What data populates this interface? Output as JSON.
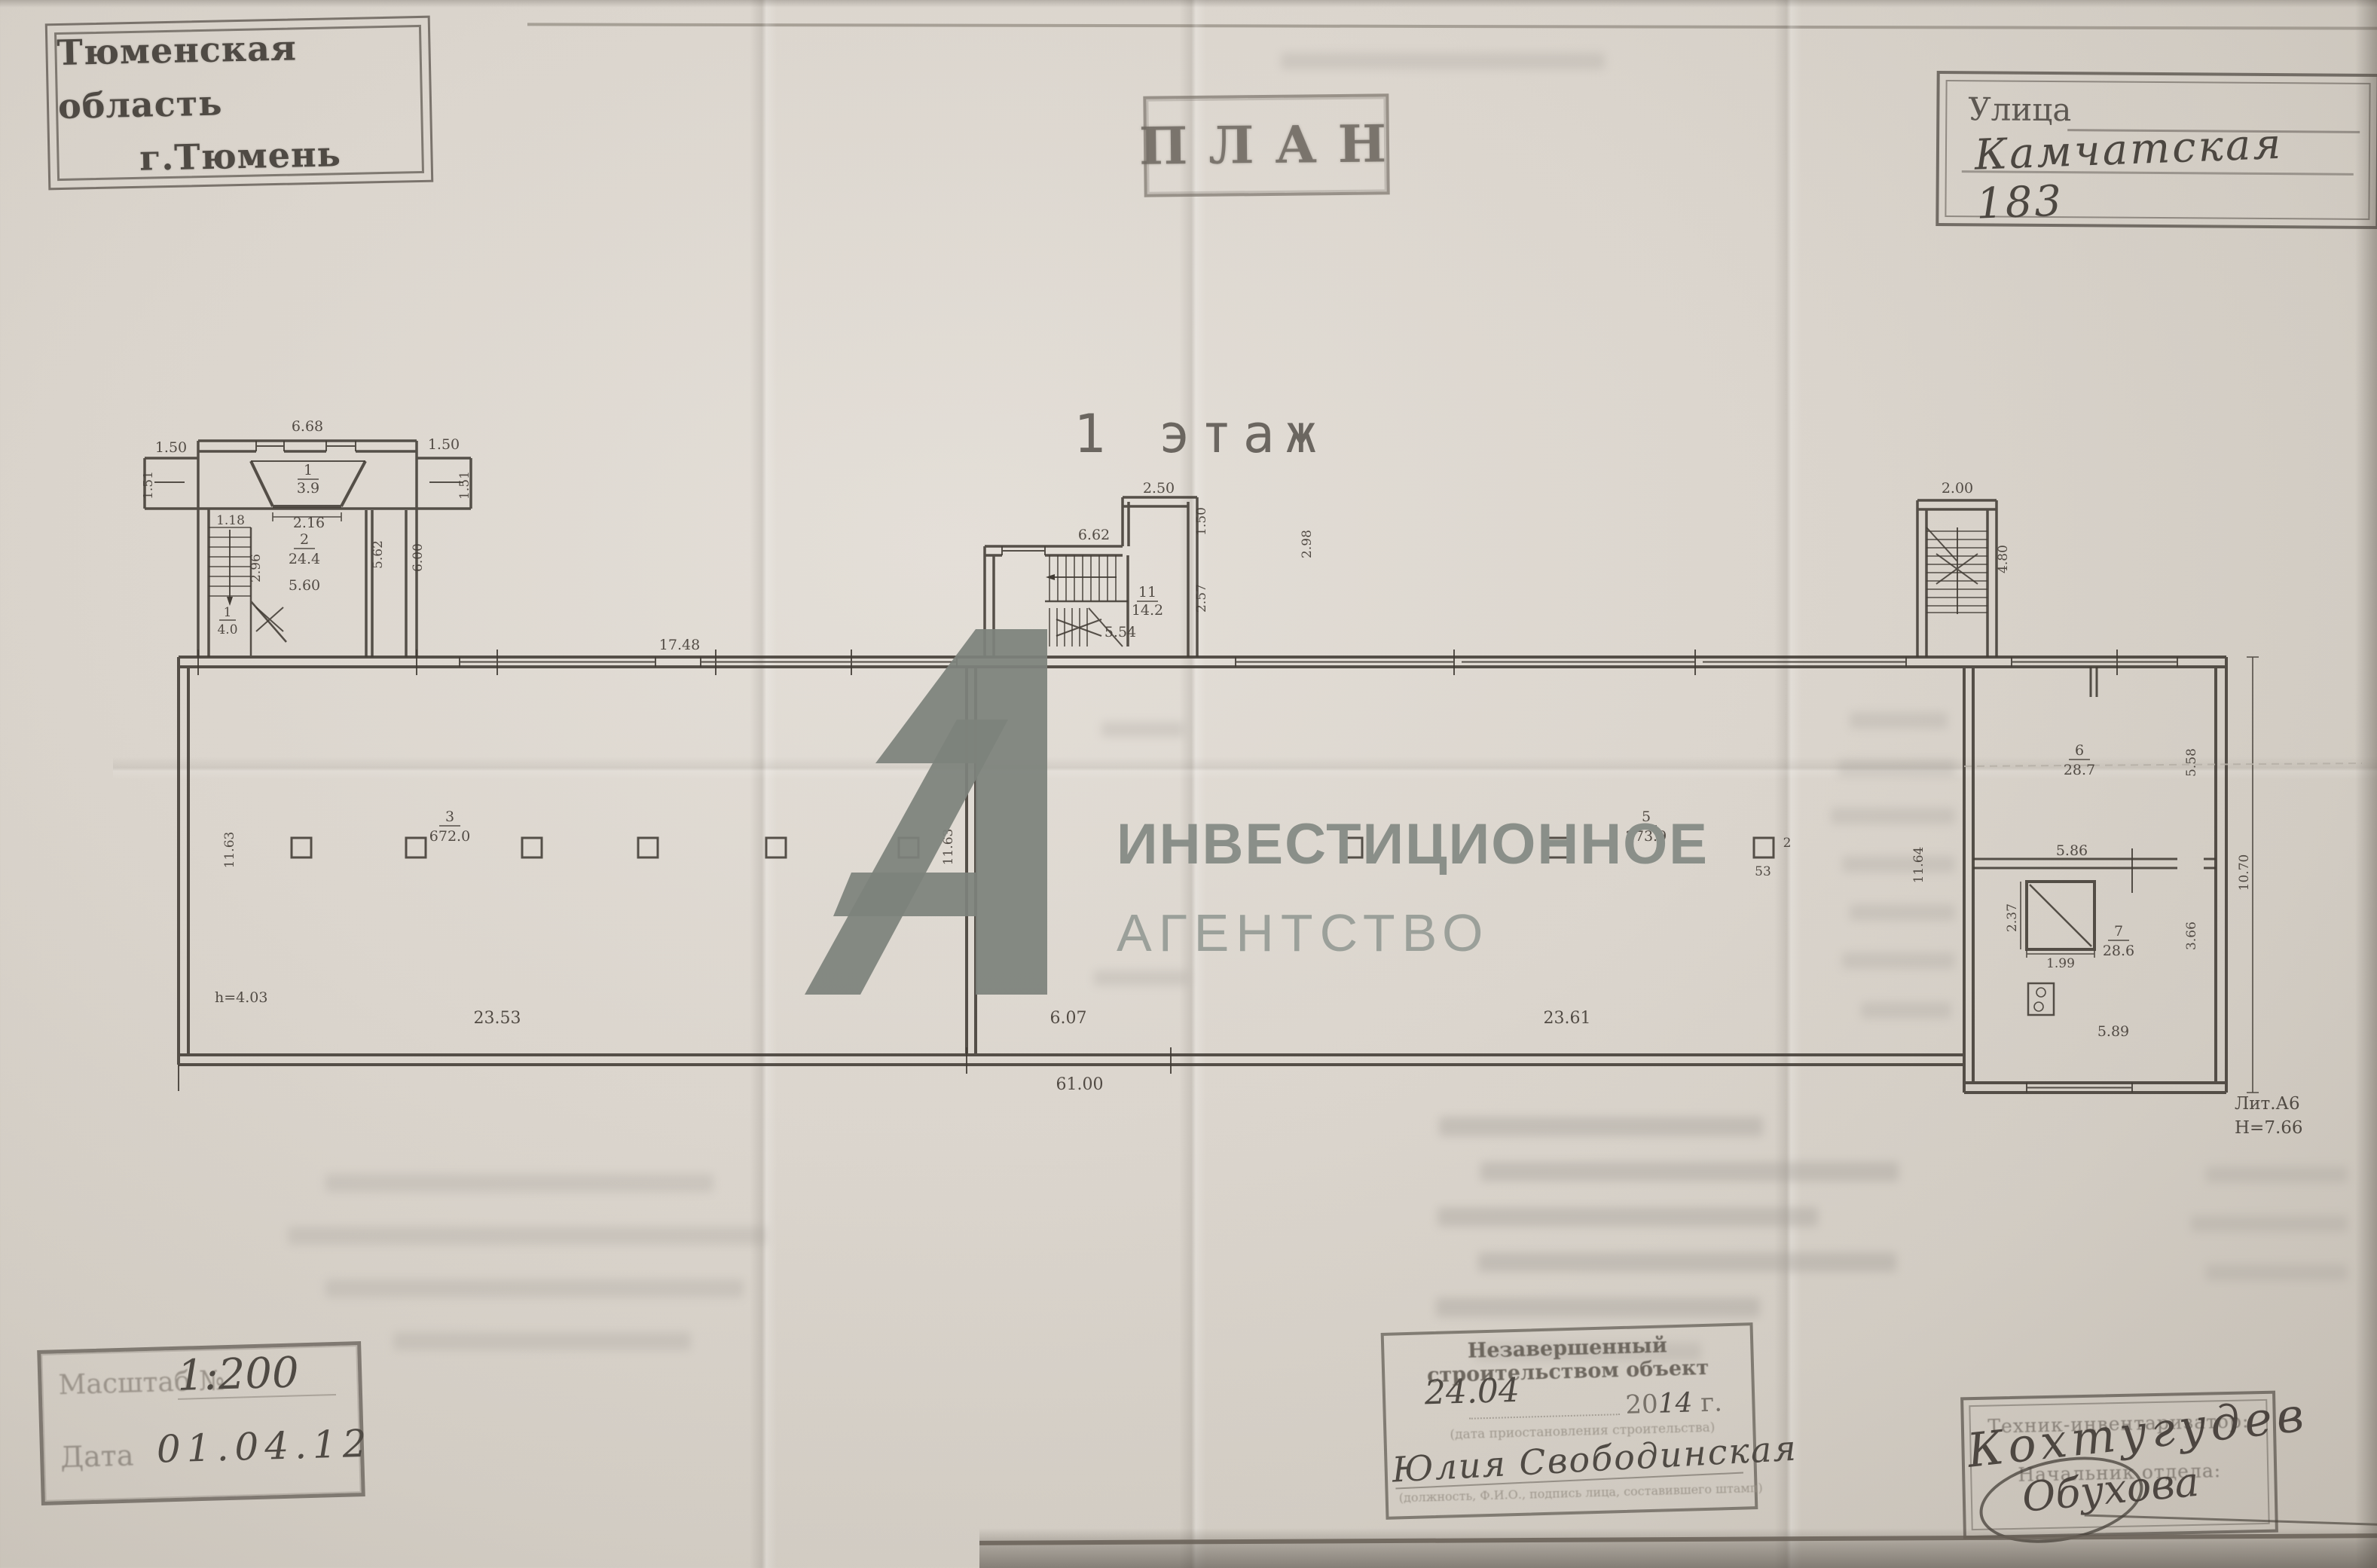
{
  "doc": {
    "region_stamp": {
      "line1": "Тюменская область",
      "line2": "г.Тюмень"
    },
    "plan_stamp": "ПЛАН",
    "street_stamp": {
      "label": "Улица",
      "value": "Камчатская 183"
    },
    "floor_title": "1 этаж",
    "watermark": {
      "logo": "А1",
      "line1": "ИНВЕСТИЦИОННОЕ",
      "line2": "АГЕНТСТВО"
    }
  },
  "plan": {
    "litera": "Лит.А6",
    "height_note": "Н=7.66",
    "hall_height": "h=4.03",
    "rooms": [
      {
        "n": "1",
        "a": "3.9"
      },
      {
        "n": "2",
        "a": "24.4"
      },
      {
        "n": "11",
        "a": "14.2"
      },
      {
        "n": "3",
        "a": "672.0"
      },
      {
        "n": "5",
        "a": "273.9"
      },
      {
        "n": "2",
        "a": "53"
      },
      {
        "n": "6",
        "a": "28.7"
      },
      {
        "n": "7",
        "a": "28.6"
      }
    ],
    "dims": {
      "vest_top": "6.68",
      "wing_l": "1.50",
      "wing_r": "1.50",
      "side_l": "1.51",
      "side_r": "1.51",
      "porch_w": "2.16",
      "stair_top": "1.18",
      "stair_side": "2.96",
      "stair_num": "1",
      "stair_bottom": "4.0",
      "room2_w": "5.60",
      "corr1": "5.62",
      "corr2": "6.00",
      "topwall": "17.48",
      "mid_top": "6.62",
      "mid_box": "2.50",
      "mid_r1": "1.50",
      "mid_w": "5.54",
      "mid_r2": "2.57",
      "mid_r3": "2.98",
      "rst_top": "2.00",
      "rst_side": "4.80",
      "hall3_side": "11.63",
      "hall3_side2": "11.63",
      "hall3_w": "23.53",
      "hall5_side": "11.64",
      "mid_bay": "6.07",
      "hall5_w": "23.61",
      "total_w": "61.00",
      "room6_side": "5.58",
      "room6_w": "5.86",
      "shaft_h": "2.37",
      "shaft_w": "1.99",
      "room7_side": "3.66",
      "room7_w": "5.89",
      "annex_side": "10.70"
    }
  },
  "footer": {
    "scale_stamp": {
      "label1": "Масштаб №",
      "value1": "1:200",
      "label2": "Дата",
      "value2": "01.04.12"
    },
    "object_stamp": {
      "title": "Незавершенный строительством объект",
      "date_hand": "24.04",
      "year_prefix": "20",
      "year_hand": "14",
      "year_suffix": " г.",
      "caption1": "(дата приостановления строительства)",
      "signature": "Юлия Свободинская",
      "caption2": "(должность, Ф.И.О., подпись лица, составившего штамп)"
    },
    "sign_stamp": {
      "role1": "Техник-инвентаризатор:",
      "sig1": "Кохтугудев",
      "role2": "Начальник отдела:",
      "sig2": "Обухова"
    }
  }
}
